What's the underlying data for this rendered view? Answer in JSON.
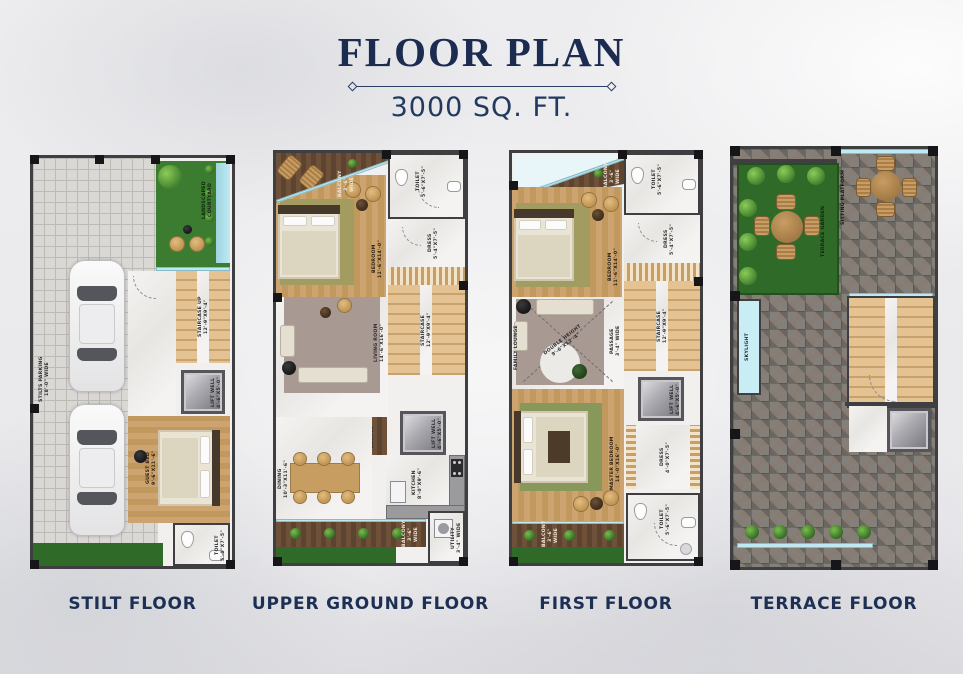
{
  "page": {
    "title": "FLOOR PLAN",
    "subtitle": "3000 SQ. FT."
  },
  "colors": {
    "accent_navy": "#1c2e52",
    "wall": "#3f3f41",
    "wood_light": "#c9a26e",
    "wood_dark": "#5f4836",
    "grass_green": "#2f6a28",
    "pool_blue": "#a9dee8",
    "stair_tan": "#ddb888",
    "stone_gray": "#847f78",
    "marble": "#f1f0ee",
    "glass_blue": "#bfe9f2"
  },
  "floors": {
    "stilt": {
      "caption": "STILT FLOOR",
      "rooms": {
        "parking": {
          "name": "STILTS PARKING",
          "dim": "18'-0\" WIDE"
        },
        "courtyard": {
          "name": "LANDSCAPED",
          "dim": "COURTYARD"
        },
        "staircase": {
          "name": "STAIRCASE UP",
          "dim": "12'-9\"X9'-4\""
        },
        "lift": {
          "name": "LIFT WELL",
          "dim": "4'-6\"X5'-0\""
        },
        "guest_bed": {
          "name": "GUEST BED",
          "dim": "9'-6\"X11'-6\""
        },
        "toilet": {
          "name": "TOILET",
          "dim": "5'-0\"X7'-5\""
        }
      }
    },
    "upper_ground": {
      "caption": "UPPER GROUND FLOOR",
      "rooms": {
        "balcony_top": {
          "name": "BALCONY",
          "dim": "3'-6\" WIDE"
        },
        "bedroom": {
          "name": "BEDROOM",
          "dim": "11'-6\"X14'-0\""
        },
        "toilet": {
          "name": "TOILET",
          "dim": "5'-6\"X7'-5\""
        },
        "dress": {
          "name": "DRESS",
          "dim": "5'-4\"X7'-5\""
        },
        "staircase": {
          "name": "STAIRCASE",
          "dim": "12'-9\"X9'-4\""
        },
        "living": {
          "name": "LIVING ROOM",
          "dim": "14'-6\"X16'-0\""
        },
        "pooja": {
          "name": "POOJA ALCOVE",
          "dim": ""
        },
        "lift": {
          "name": "LIFT WELL",
          "dim": "4'-6\"X5'-0\""
        },
        "dining": {
          "name": "DINING",
          "dim": "10'-3\"X11'-6\""
        },
        "kitchen": {
          "name": "KITCHEN",
          "dim": "8'-0\"X9'-6\""
        },
        "utility": {
          "name": "UTILITY",
          "dim": "3'-4\" WIDE"
        },
        "balcony_bottom": {
          "name": "BALCONY",
          "dim": "3'-6\" WIDE"
        }
      }
    },
    "first": {
      "caption": "FIRST FLOOR",
      "rooms": {
        "balcony_top": {
          "name": "BALCONY",
          "dim": "3'-6\" WIDE"
        },
        "bedroom": {
          "name": "BEDROOM",
          "dim": "11'-6\"X14'-0\""
        },
        "toilet_top": {
          "name": "TOILET",
          "dim": "5'-6\"X7'-5\""
        },
        "dress_top": {
          "name": "DRESS",
          "dim": "5'-4\"X7'-5\""
        },
        "staircase": {
          "name": "STAIRCASE",
          "dim": "12'-9\"X9'-4\""
        },
        "family_lounge": {
          "name": "FAMILY LOUNGE",
          "dim": ""
        },
        "double_height": {
          "name": "DOUBLE HEIGHT",
          "dim": "9'-6\"X12'-4\""
        },
        "passage": {
          "name": "PASSAGE",
          "dim": "3'-4\" WIDE"
        },
        "master_bedroom": {
          "name": "MASTER BEDROOM",
          "dim": "14'-0\"X16'-0\""
        },
        "lift": {
          "name": "LIFT WELL",
          "dim": "4'-6\"X5'-0\""
        },
        "dress_bottom": {
          "name": "DRESS",
          "dim": "4'-0\"X7'-5\""
        },
        "toilet_bottom": {
          "name": "TOILET",
          "dim": "5'-6\"X7'-5\""
        },
        "balcony_bottom": {
          "name": "BALCONY",
          "dim": "3'-6\" WIDE"
        }
      }
    },
    "terrace": {
      "caption": "TERRACE FLOOR",
      "rooms": {
        "garden": {
          "name": "TERRACE GARDEN",
          "dim": ""
        },
        "sitting": {
          "name": "SITTING PLATFORM",
          "dim": ""
        },
        "skylight": {
          "name": "SKYLIGHT",
          "dim": ""
        }
      }
    }
  }
}
